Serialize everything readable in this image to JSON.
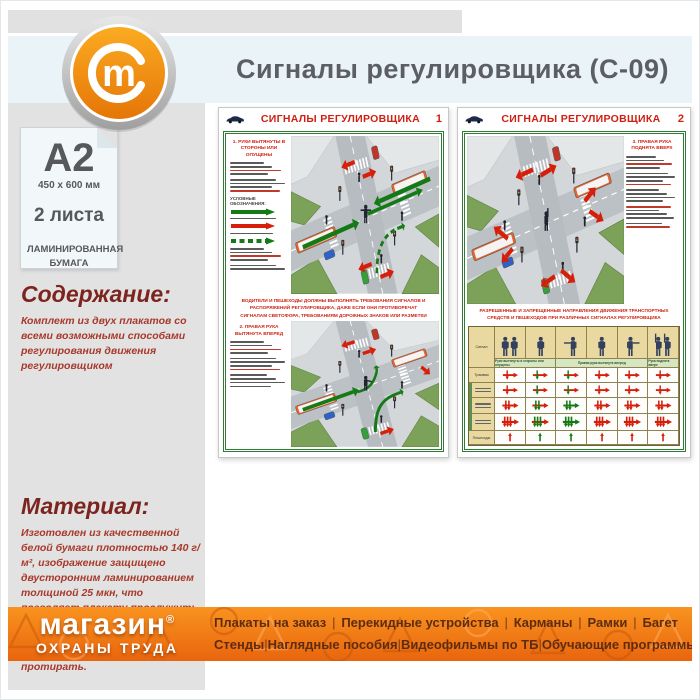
{
  "header": {
    "title": "Сигналы регулировщика (С-09)",
    "logo_letter": "m"
  },
  "sidebar": {
    "format": "A2",
    "size": "450 x 600 мм",
    "sheets": "2 листа",
    "paper": "ЛАМИНИРОВАННАЯ БУМАГА",
    "content_heading": "Содержание:",
    "content_text": "Комплект из двух плакатов со всеми возможными способами регулирования движения регулировщиком",
    "material_heading": "Материал:",
    "material_text": "Изготовлен из качественной белой бумаги плотностью 140 г/м², изображение защищено двусторонним ламинированием толщиной 25 мкн, что позволяет плакату прослужить намного дольше бумажного варианта и такой плакат не боится влаги - его смело можно протирать."
  },
  "posters": {
    "sheet_title": "СИГНАЛЫ РЕГУЛИРОВЩИКА",
    "poster1": {
      "number": "1",
      "section1_heading": "1. РУКИ ВЫТЯНУТЫ В СТОРОНЫ ИЛИ ОПУЩЕНЫ",
      "legend_heading": "УСЛОВНЫЕ ОБОЗНАЧЕНИЯ:",
      "middle_text": "ВОДИТЕЛИ И ПЕШЕХОДЫ ДОЛЖНЫ ВЫПОЛНЯТЬ ТРЕБОВАНИЯ СИГНАЛОВ И РАСПОРЯЖЕНИЙ РЕГУЛИРОВЩИКА, ДАЖЕ ЕСЛИ ОНИ ПРОТИВОРЕЧАТ СИГНАЛАМ СВЕТОФОРА, ТРЕБОВАНИЯМ ДОРОЖНЫХ ЗНАКОВ ИЛИ РАЗМЕТКИ",
      "section2_heading": "2. ПРАВАЯ РУКА ВЫТЯНУТА ВПЕРЕД"
    },
    "poster2": {
      "number": "2",
      "section_heading": "3. ПРАВАЯ РУКА ПОДНЯТА ВВЕРХ",
      "caption": "РАЗРЕШЕННЫЕ И ЗАПРЕЩЕННЫЕ НАПРАВЛЕНИЯ ДВИЖЕНИЯ ТРАНСПОРТНЫХ СРЕДСТВ И ПЕШЕХОДОВ ПРИ РАЗЛИЧНЫХ СИГНАЛАХ РЕГУЛИРОВЩИКА",
      "table": {
        "corner_label": "Сигнал",
        "group_labels": [
          "Руки вытянуты в стороны или опущены",
          "Правая рука вытянута вперед",
          "Рука поднята вверх"
        ],
        "row_labels": [
          "Трамваи",
          "",
          "",
          "",
          "Пешеходы"
        ],
        "figure_poses": [
          "pair",
          "side",
          "arm-left",
          "front",
          "arm-right",
          "pair-up"
        ],
        "rows": [
          {
            "glyph": "v1",
            "cells": [
              "R",
              "M",
              "M",
              "R",
              "R",
              "R"
            ]
          },
          {
            "glyph": "v1",
            "cells": [
              "R",
              "M",
              "M",
              "R",
              "R",
              "R"
            ]
          },
          {
            "glyph": "v2",
            "cells": [
              "R",
              "M",
              "G",
              "R",
              "R",
              "R"
            ]
          },
          {
            "glyph": "v3",
            "cells": [
              "R",
              "M",
              "G",
              "R",
              "R",
              "R"
            ]
          },
          {
            "glyph": "ped",
            "cells": [
              "R",
              "G",
              "G",
              "R",
              "R",
              "R"
            ]
          }
        ]
      }
    }
  },
  "footer": {
    "brand_line1": "магазин",
    "brand_mark": "®",
    "brand_line2": "ОХРАНЫ ТРУДА",
    "menu_row1": [
      "Плакаты на заказ",
      "Перекидные устройства",
      "Карманы",
      "Рамки",
      "Багет"
    ],
    "menu_row2": [
      "Стенды",
      "Наглядные пособия",
      "Видеофильмы по ТБ",
      "Обучающие программы"
    ]
  },
  "colors": {
    "accent_orange": "#ef7712",
    "header_band_blue": "#eaf4f8",
    "poster_red": "#cf1f10",
    "poster_green_frame": "#2e7b33",
    "maroon_heading": "#7c241e",
    "maroon_text": "#a8392b",
    "footer_menu_text": "#5e2c10",
    "sidebar_gray": "#e2e2e2"
  }
}
